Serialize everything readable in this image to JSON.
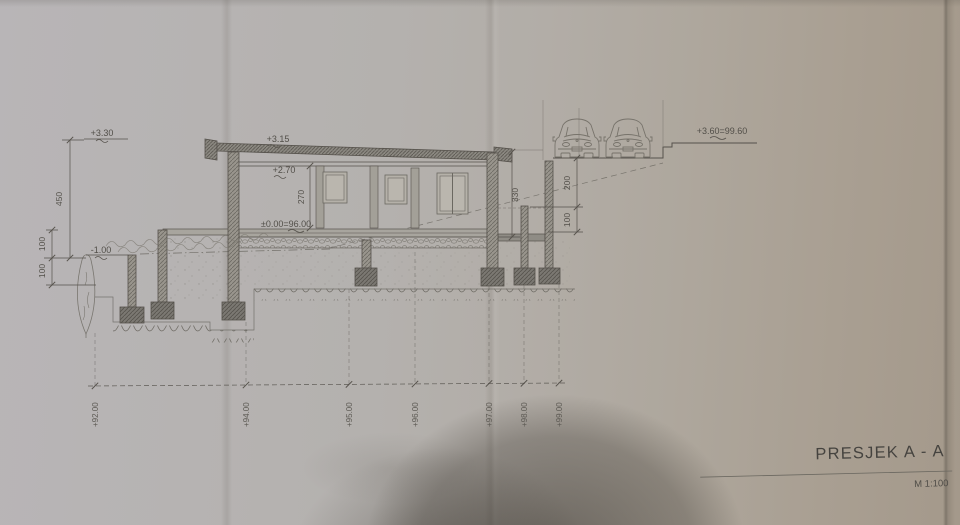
{
  "section": {
    "title": "PRESJEK A - A",
    "scale": "M 1:100",
    "levels": {
      "roof_parapet": "+3.30",
      "roof": "+3.15",
      "ceiling": "+2.70",
      "floor": "±0.00=96.00",
      "ground": "-1.00",
      "street": "+3.60=99.60"
    },
    "dims": {
      "total_height": "450",
      "ground_upper": "100",
      "ground_lower": "100",
      "room_height": "270",
      "rear_wall": "330",
      "platform_upper": "200",
      "platform_lower": "100"
    },
    "datum_labels": [
      "+92.00",
      "+94.00",
      "+95.00",
      "+96.00",
      "+97.00",
      "+98.00",
      "+99.00"
    ]
  },
  "colors": {
    "paper": "#b3afab",
    "paper_warm": "#a89d90",
    "ink": "#56524c",
    "wall_fill": "#98948c",
    "shadow": "#463f36"
  }
}
